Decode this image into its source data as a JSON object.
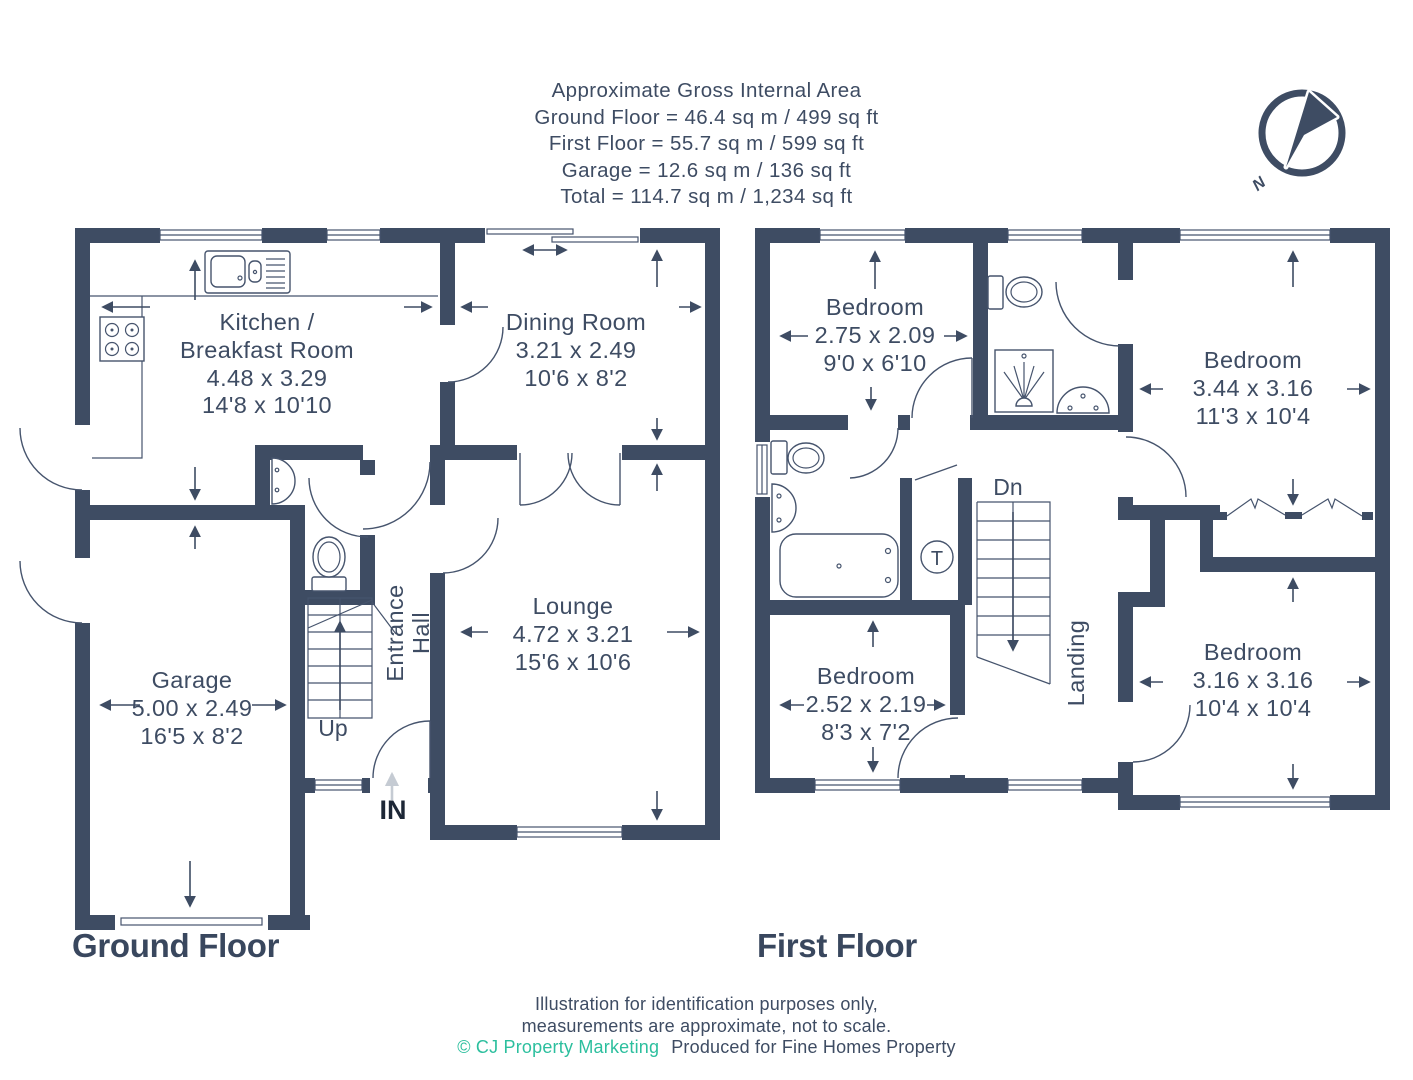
{
  "header": {
    "title": "Approximate Gross Internal Area",
    "ground_area": "Ground Floor = 46.4 sq m / 499 sq ft",
    "first_area": "First Floor = 55.7 sq m / 599 sq ft",
    "garage_area": "Garage = 12.6 sq m / 136 sq ft",
    "total_area": "Total = 114.7 sq m / 1,234 sq ft"
  },
  "compass": {
    "north": "N"
  },
  "ground_floor": {
    "label": "Ground Floor",
    "kitchen": {
      "line1": "Kitchen /",
      "line2": "Breakfast Room",
      "metric": "4.48 x 3.29",
      "imperial": "14'8 x 10'10"
    },
    "dining": {
      "name": "Dining Room",
      "metric": "3.21 x 2.49",
      "imperial": "10'6 x 8'2"
    },
    "lounge": {
      "name": "Lounge",
      "metric": "4.72 x 3.21",
      "imperial": "15'6 x 10'6"
    },
    "garage": {
      "name": "Garage",
      "metric": "5.00 x 2.49",
      "imperial": "16'5 x 8'2"
    },
    "hall": {
      "line1": "Entrance",
      "line2": "Hall"
    },
    "stairs": "Up",
    "entrance": "IN"
  },
  "first_floor": {
    "label": "First Floor",
    "bedroom1": {
      "name": "Bedroom",
      "metric": "2.75 x 2.09",
      "imperial": "9'0 x 6'10"
    },
    "bedroom2": {
      "name": "Bedroom",
      "metric": "3.44 x 3.16",
      "imperial": "11'3 x 10'4"
    },
    "bedroom3": {
      "name": "Bedroom",
      "metric": "2.52 x 2.19",
      "imperial": "8'3 x 7'2"
    },
    "bedroom4": {
      "name": "Bedroom",
      "metric": "3.16 x 3.16",
      "imperial": "10'4 x 10'4"
    },
    "landing": "Landing",
    "stairs": "Dn",
    "tank": "T"
  },
  "footer": {
    "line1": "Illustration for identification purposes only,",
    "line2": "measurements are approximate, not to scale.",
    "credit": "© CJ Property Marketing",
    "produced": "Produced for Fine Homes Property"
  },
  "colors": {
    "wall": "#3e4c63",
    "accent_teal": "#2cbf9e",
    "light_arrow": "#c5cbd3"
  }
}
